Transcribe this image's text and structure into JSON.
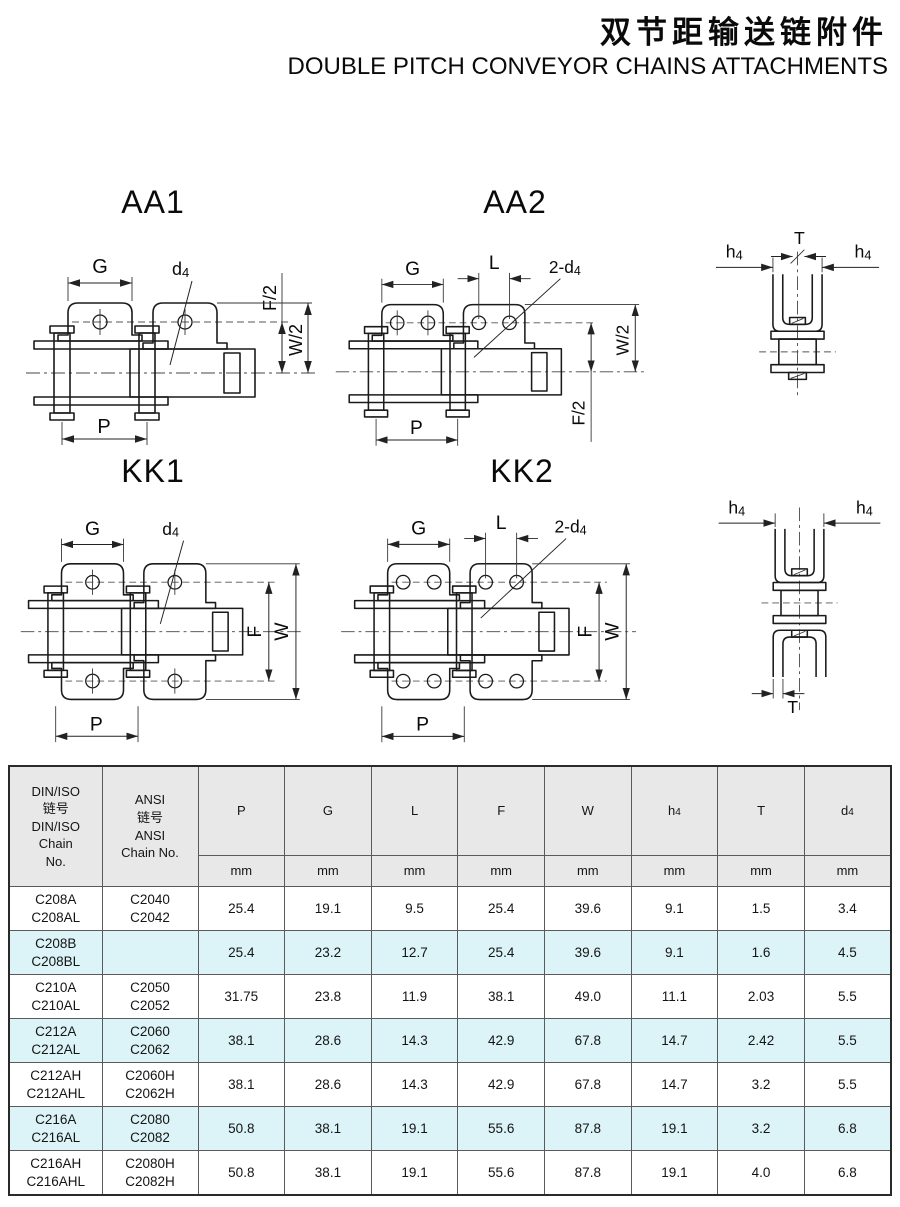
{
  "page": {
    "title_zh": "双节距输送链附件",
    "title_en": "DOUBLE PITCH CONVEYOR CHAINS ATTACHMENTS"
  },
  "diagrams": {
    "aa1": {
      "label": "AA1",
      "dim_g": "G",
      "dim_p": "P",
      "dim_f2": "F/2",
      "dim_w2": "W/2",
      "d4_base": "d",
      "d4_sub": "4"
    },
    "aa2": {
      "label": "AA2",
      "dim_g": "G",
      "dim_l": "L",
      "dim_p": "P",
      "dim_f2": "F/2",
      "dim_w2": "W/2",
      "d4_base": "2-d",
      "d4_sub": "4"
    },
    "kk1": {
      "label": "KK1",
      "dim_g": "G",
      "dim_p": "P",
      "dim_f": "F",
      "dim_w": "W",
      "d4_base": "d",
      "d4_sub": "4"
    },
    "kk2": {
      "label": "KK2",
      "dim_g": "G",
      "dim_l": "L",
      "dim_p": "P",
      "dim_f": "F",
      "dim_w": "W",
      "d4_base": "2-d",
      "d4_sub": "4"
    },
    "end_aa": {
      "dim_t": "T",
      "h4_base": "h",
      "h4_sub": "4"
    },
    "end_kk": {
      "dim_t": "T",
      "h4_base": "h",
      "h4_sub": "4"
    }
  },
  "table": {
    "header": {
      "chain_cols": [
        {
          "lines": [
            "DIN/ISO",
            "链号",
            "DIN/ISO",
            "Chain",
            "No."
          ]
        },
        {
          "lines": [
            "ANSI",
            "链号",
            "ANSI",
            "Chain No."
          ]
        }
      ],
      "dim_cols": [
        {
          "base": "P",
          "sub": "",
          "unit": "mm"
        },
        {
          "base": "G",
          "sub": "",
          "unit": "mm"
        },
        {
          "base": "L",
          "sub": "",
          "unit": "mm"
        },
        {
          "base": "F",
          "sub": "",
          "unit": "mm"
        },
        {
          "base": "W",
          "sub": "",
          "unit": "mm"
        },
        {
          "base": "h",
          "sub": "4",
          "unit": "mm"
        },
        {
          "base": "T",
          "sub": "",
          "unit": "mm"
        },
        {
          "base": "d",
          "sub": "4",
          "unit": "mm"
        }
      ]
    },
    "rows": [
      {
        "din": [
          "C208A",
          "C208AL"
        ],
        "ansi": [
          "C2040",
          "C2042"
        ],
        "values": [
          "25.4",
          "19.1",
          "9.5",
          "25.4",
          "39.6",
          "9.1",
          "1.5",
          "3.4"
        ],
        "highlight": false
      },
      {
        "din": [
          "C208B",
          "C208BL"
        ],
        "ansi": [],
        "values": [
          "25.4",
          "23.2",
          "12.7",
          "25.4",
          "39.6",
          "9.1",
          "1.6",
          "4.5"
        ],
        "highlight": true
      },
      {
        "din": [
          "C210A",
          "C210AL"
        ],
        "ansi": [
          "C2050",
          "C2052"
        ],
        "values": [
          "31.75",
          "23.8",
          "11.9",
          "38.1",
          "49.0",
          "11.1",
          "2.03",
          "5.5"
        ],
        "highlight": false
      },
      {
        "din": [
          "C212A",
          "C212AL"
        ],
        "ansi": [
          "C2060",
          "C2062"
        ],
        "values": [
          "38.1",
          "28.6",
          "14.3",
          "42.9",
          "67.8",
          "14.7",
          "2.42",
          "5.5"
        ],
        "highlight": true
      },
      {
        "din": [
          "C212AH",
          "C212AHL"
        ],
        "ansi": [
          "C2060H",
          "C2062H"
        ],
        "values": [
          "38.1",
          "28.6",
          "14.3",
          "42.9",
          "67.8",
          "14.7",
          "3.2",
          "5.5"
        ],
        "highlight": false
      },
      {
        "din": [
          "C216A",
          "C216AL"
        ],
        "ansi": [
          "C2080",
          "C2082"
        ],
        "values": [
          "50.8",
          "38.1",
          "19.1",
          "55.6",
          "87.8",
          "19.1",
          "3.2",
          "6.8"
        ],
        "highlight": true
      },
      {
        "din": [
          "C216AH",
          "C216AHL"
        ],
        "ansi": [
          "C2080H",
          "C2082H"
        ],
        "values": [
          "50.8",
          "38.1",
          "19.1",
          "55.6",
          "87.8",
          "19.1",
          "4.0",
          "6.8"
        ],
        "highlight": false
      }
    ]
  },
  "colors": {
    "row_highlight": "#dcf4f7",
    "header_bg": "#e8e8e8",
    "line": "#1a1a1a"
  }
}
